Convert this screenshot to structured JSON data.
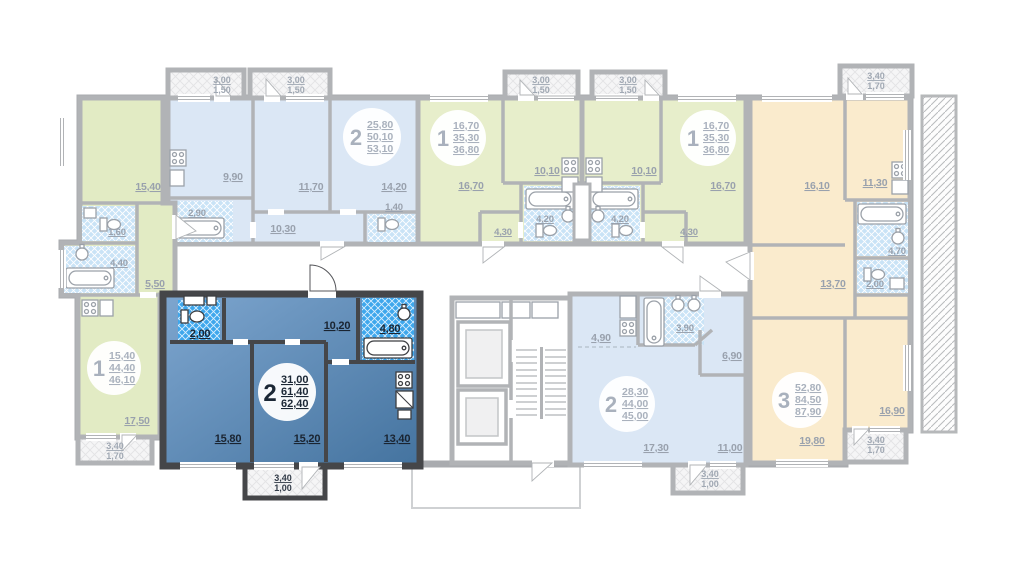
{
  "floorplan": {
    "colors": {
      "selected_fill": "#4a7cb0",
      "selected_wall": "#454649",
      "muted_label": "#99a1ad"
    },
    "apartments": {
      "top_left_2": {
        "type": "2",
        "living": "25,80",
        "total": "50,10",
        "total_full": "53,10",
        "rooms": {
          "kitchen": "9,90",
          "room1": "11,70",
          "room2": "14,20",
          "bath": "2,90",
          "hall": "10,30",
          "wc": "1,40"
        },
        "balcony1": {
          "a": "3,00",
          "b": "1,50"
        },
        "balcony2": {
          "a": "3,00",
          "b": "1,50"
        }
      },
      "top_mid_left_1": {
        "type": "1",
        "living": "16,70",
        "total": "35,30",
        "total_full": "36,80",
        "rooms": {
          "room": "16,70",
          "kitchen": "10,10",
          "bath": "4,20",
          "hall": "4,30"
        },
        "balcony": {
          "a": "3,00",
          "b": "1,50"
        }
      },
      "top_mid_right_1": {
        "type": "1",
        "living": "16,70",
        "total": "35,30",
        "total_full": "36,80",
        "rooms": {
          "room": "16,70",
          "kitchen": "10,10",
          "bath": "4,20",
          "hall": "4,30"
        },
        "balcony": {
          "a": "3,00",
          "b": "1,50"
        }
      },
      "left_1": {
        "type": "1",
        "living": "15,40",
        "total": "44,40",
        "total_full": "46,10",
        "rooms": {
          "room1": "15,40",
          "wc": "1,60",
          "bath": "4,40",
          "hall": "5,50",
          "room2": "17,50"
        },
        "balcony": {
          "a": "3,40",
          "b": "1,70"
        }
      },
      "selected_2": {
        "type": "2",
        "living": "31,00",
        "total": "61,40",
        "total_full": "62,40",
        "rooms": {
          "wc": "2,00",
          "hall": "10,20",
          "bath": "4,80",
          "room1": "15,80",
          "room2": "15,20",
          "kitchen": "13,40"
        },
        "balcony": {
          "a": "3,40",
          "b": "1,00"
        }
      },
      "bottom_mid_2": {
        "type": "2",
        "living": "28,30",
        "total": "44,00",
        "total_full": "45,00",
        "rooms": {
          "kitchen": "4,90",
          "bath": "3,90",
          "hall": "6,90",
          "room1": "17,30",
          "room2": "11,00"
        },
        "balcony": {
          "a": "3,40",
          "b": "1,00"
        }
      },
      "right_3": {
        "type": "3",
        "living": "52,80",
        "total": "84,50",
        "total_full": "87,90",
        "rooms": {
          "room1": "16,10",
          "kitchen": "11,30",
          "hall": "13,70",
          "wc": "2,00",
          "bath": "4,70",
          "room2": "19,80",
          "room3": "16,90"
        },
        "balcony_top": {
          "a": "3,40",
          "b": "1,70"
        },
        "balcony_bottom": {
          "a": "3,40",
          "b": "1,70"
        }
      }
    }
  }
}
